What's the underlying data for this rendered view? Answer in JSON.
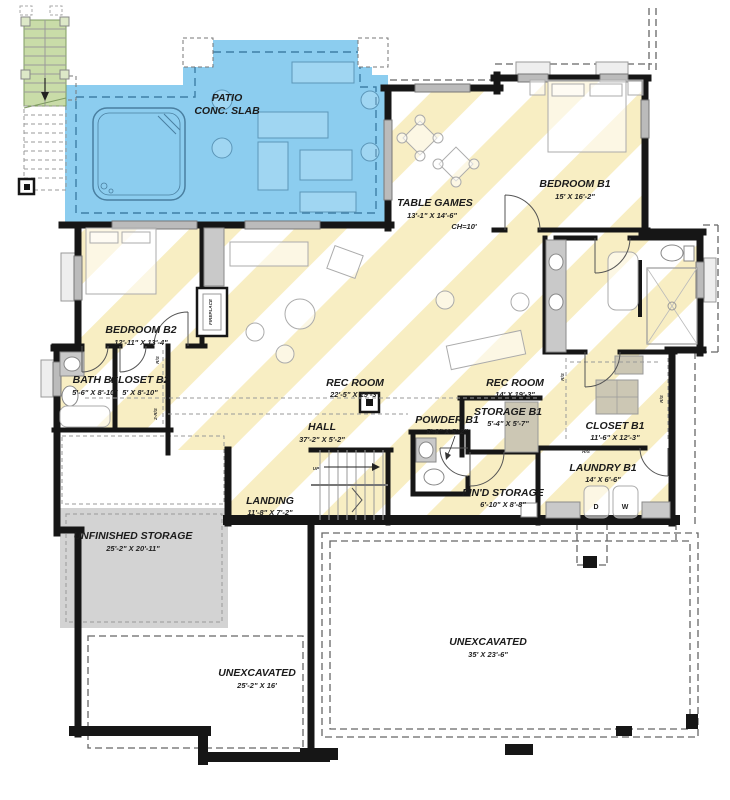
{
  "colors": {
    "patio_blue": "#8CCDEF",
    "stripe_yellow": "#F8EEC3",
    "storage_gray": "#D3D3D3",
    "stair_green": "#C9DCA8",
    "wall_black": "#161616"
  },
  "rooms": [
    {
      "id": "patio",
      "name": "PATIO",
      "name2": "CONC. SLAB"
    },
    {
      "id": "table_games",
      "name": "TABLE GAMES",
      "dims": "13'-1\" X 14'-6\"",
      "ch": "CH=10'"
    },
    {
      "id": "bedroom_b1",
      "name": "BEDROOM B1",
      "dims": "15' X 16'-2\""
    },
    {
      "id": "bedroom_b2",
      "name": "BEDROOM B2",
      "dims": "12'-11\" X 13'-4\""
    },
    {
      "id": "bath_b2",
      "name": "BATH B2",
      "dims": "5'-6\" X 8'-10\""
    },
    {
      "id": "closet_b2",
      "name": "CLOSET B2",
      "dims": "5' X 8'-10\""
    },
    {
      "id": "rec_room_main",
      "name": "REC ROOM",
      "dims": "22'-5\" X 19'-3\""
    },
    {
      "id": "rec_room_small",
      "name": "REC ROOM",
      "dims": "14' X 19'-3\""
    },
    {
      "id": "hall",
      "name": "HALL",
      "dims": "37'-2\" X 5'-2\""
    },
    {
      "id": "powder_b1",
      "name": "POWDER B1",
      "dims": "5'-8\" X 5'-2\""
    },
    {
      "id": "storage_b1",
      "name": "STORAGE B1",
      "dims": "5'-4\" X 5'-7\""
    },
    {
      "id": "closet_b1",
      "name": "CLOSET B1",
      "dims": "11'-6\" X 12'-3\""
    },
    {
      "id": "laundry_b1",
      "name": "LAUNDRY B1",
      "dims": "14' X 6'-6\""
    },
    {
      "id": "landing",
      "name": "LANDING",
      "dims": "11'-8\" X 7'-2\""
    },
    {
      "id": "find_storage",
      "name": "FIN'D STORAGE",
      "dims": "6'-10\" X 8'-8\""
    },
    {
      "id": "unfinished_storage",
      "name": "UNFINISHED STORAGE",
      "dims": "25'-2\" X 20'-11\""
    },
    {
      "id": "unexcavated_center",
      "name": "UNEXCAVATED",
      "dims": "25'-2\" X 16'"
    },
    {
      "id": "unexcavated_right",
      "name": "UNEXCAVATED",
      "dims": "35' X 23'-6\""
    }
  ],
  "labels": {
    "fireplace": "FIREPLACE",
    "up": "UP",
    "washer": "W",
    "dryer": "D",
    "rod_shelf": "R/S",
    "rod_shelf_double": "2-R/S"
  }
}
